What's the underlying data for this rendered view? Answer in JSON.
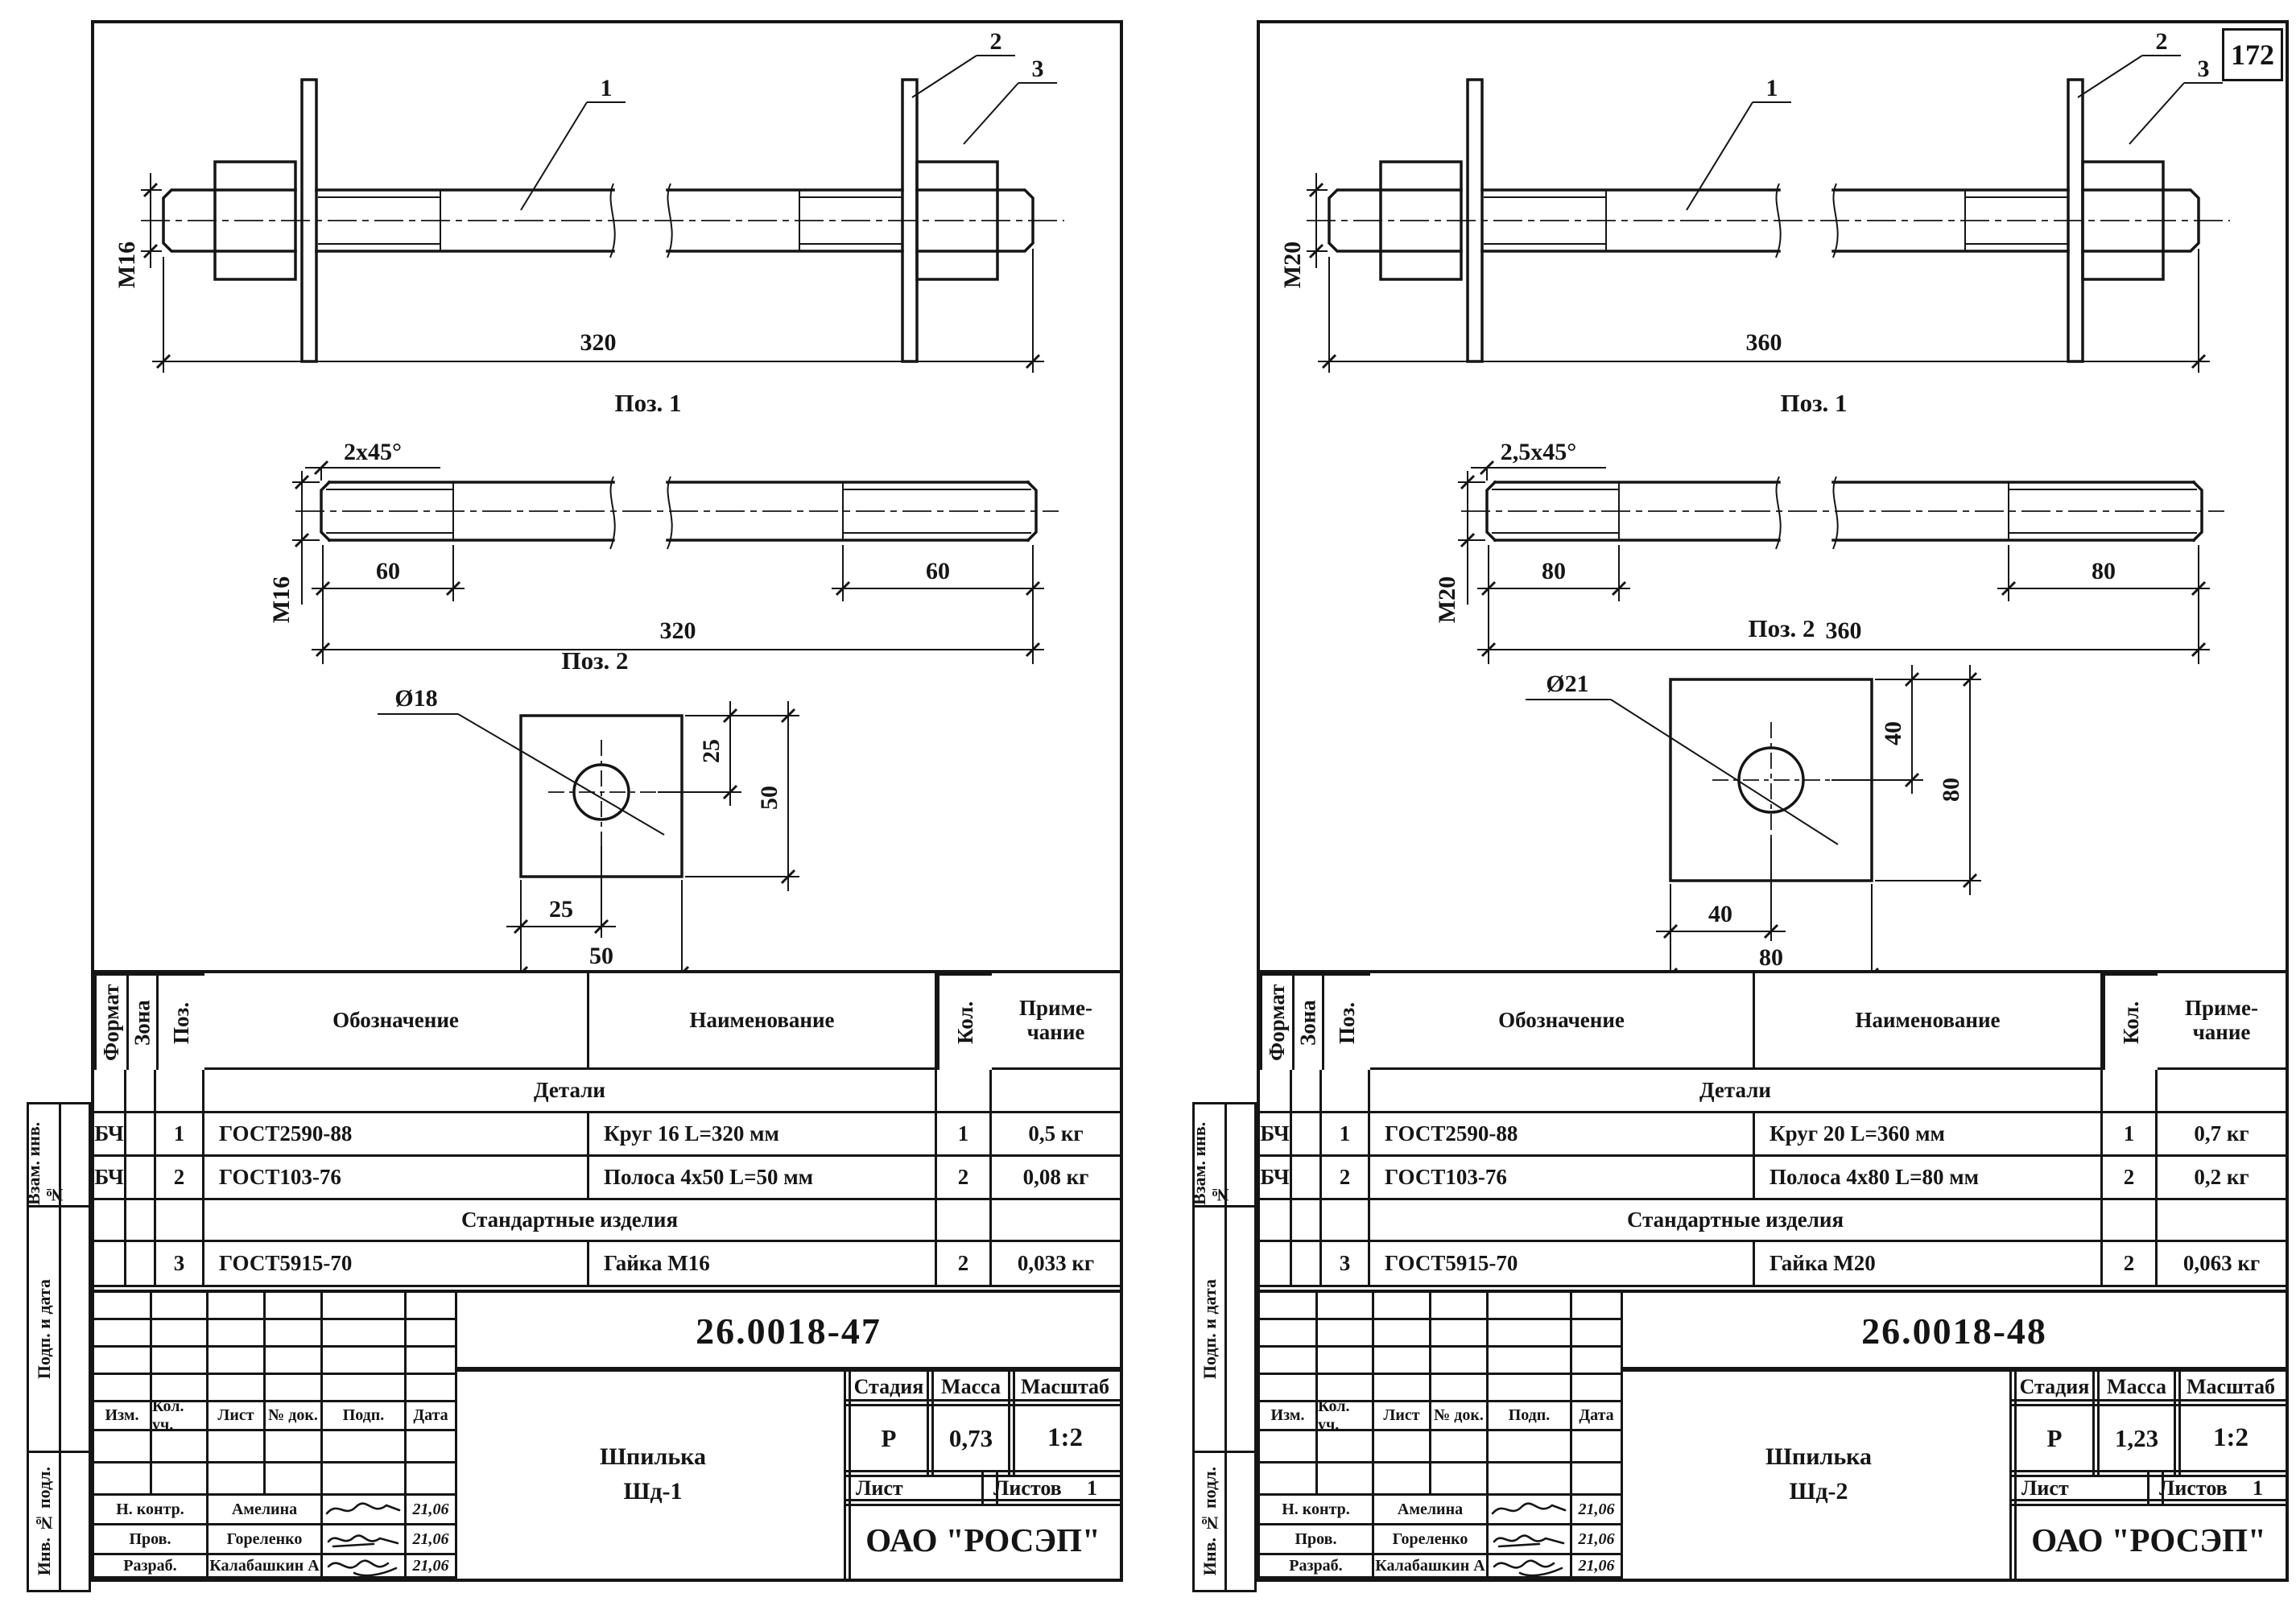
{
  "page": {
    "number": "172"
  },
  "sheets": [
    {
      "drawing": {
        "assembly": {
          "callout1": "1",
          "callout2": "2",
          "callout3": "3",
          "diameter": "M16",
          "length": "320"
        },
        "pos1": {
          "title": "Поз. 1",
          "chamfer": "2x45°",
          "diameter": "M16",
          "thread_left": "60",
          "thread_right": "60",
          "length": "320"
        },
        "pos2": {
          "title": "Поз. 2",
          "hole_dia": "Ø18",
          "offset_v": "25",
          "side_v": "50",
          "offset_h": "25",
          "side_h": "50"
        }
      },
      "spec": {
        "col_format": "Формат",
        "col_zone": "Зона",
        "col_pos": "Поз.",
        "col_desig": "Обозначение",
        "col_name": "Наименование",
        "col_qty": "Кол.",
        "col_note_1": "Приме-",
        "col_note_2": "чание",
        "section1": "Детали",
        "row1": {
          "format": "БЧ",
          "pos": "1",
          "desig": "ГОСТ2590-88",
          "name": "Круг 16 L=320 мм",
          "qty": "1",
          "note": "0,5 кг"
        },
        "row2": {
          "format": "БЧ",
          "pos": "2",
          "desig": "ГОСТ103-76",
          "name": "Полоса 4x50 L=50 мм",
          "qty": "2",
          "note": "0,08 кг"
        },
        "section2": "Стандартные изделия",
        "row3": {
          "pos": "3",
          "desig": "ГОСТ5915-70",
          "name": "Гайка М16",
          "qty": "2",
          "note": "0,033 кг"
        }
      },
      "title_block": {
        "doc_number": "26.0018-47",
        "rev": {
          "izm": "Изм.",
          "kol": "Кол. уч.",
          "list": "Лист",
          "doc": "№ док.",
          "podp": "Подп.",
          "data": "Дата"
        },
        "product1": "Шпилька",
        "product2": "Шд-1",
        "stage_h": "Стадия",
        "mass_h": "Масса",
        "scale_h": "Масштаб",
        "stage": "Р",
        "mass": "0,73",
        "scale": "1:2",
        "list_h": "Лист",
        "listov_h": "Листов",
        "listov_v": "1",
        "sig1": {
          "role": "Н. контр.",
          "name": "Амелина",
          "date": "21,06"
        },
        "sig2": {
          "role": "Пров.",
          "name": "Гореленко",
          "date": "21,06"
        },
        "sig3": {
          "role": "Разраб.",
          "name": "Калабашкин А",
          "date": "21,06"
        },
        "company": "ОАО \"РОСЭП\""
      },
      "sidebar": {
        "box1": "Взам. инв. №",
        "box2": "Подп. и дата",
        "box3": "Инв. № подл."
      }
    },
    {
      "drawing": {
        "assembly": {
          "callout1": "1",
          "callout2": "2",
          "callout3": "3",
          "diameter": "M20",
          "length": "360"
        },
        "pos1": {
          "title": "Поз. 1",
          "chamfer": "2,5x45°",
          "diameter": "M20",
          "thread_left": "80",
          "thread_right": "80",
          "length": "360"
        },
        "pos2": {
          "title": "Поз. 2",
          "hole_dia": "Ø21",
          "offset_v": "40",
          "side_v": "80",
          "offset_h": "40",
          "side_h": "80"
        }
      },
      "spec": {
        "col_format": "Формат",
        "col_zone": "Зона",
        "col_pos": "Поз.",
        "col_desig": "Обозначение",
        "col_name": "Наименование",
        "col_qty": "Кол.",
        "col_note_1": "Приме-",
        "col_note_2": "чание",
        "section1": "Детали",
        "row1": {
          "format": "БЧ",
          "pos": "1",
          "desig": "ГОСТ2590-88",
          "name": "Круг 20 L=360 мм",
          "qty": "1",
          "note": "0,7 кг"
        },
        "row2": {
          "format": "БЧ",
          "pos": "2",
          "desig": "ГОСТ103-76",
          "name": "Полоса 4x80 L=80 мм",
          "qty": "2",
          "note": "0,2 кг"
        },
        "section2": "Стандартные изделия",
        "row3": {
          "pos": "3",
          "desig": "ГОСТ5915-70",
          "name": "Гайка М20",
          "qty": "2",
          "note": "0,063 кг"
        }
      },
      "title_block": {
        "doc_number": "26.0018-48",
        "rev": {
          "izm": "Изм.",
          "kol": "Кол. уч.",
          "list": "Лист",
          "doc": "№ док.",
          "podp": "Подп.",
          "data": "Дата"
        },
        "product1": "Шпилька",
        "product2": "Шд-2",
        "stage_h": "Стадия",
        "mass_h": "Масса",
        "scale_h": "Масштаб",
        "stage": "Р",
        "mass": "1,23",
        "scale": "1:2",
        "list_h": "Лист",
        "listov_h": "Листов",
        "listov_v": "1",
        "sig1": {
          "role": "Н. контр.",
          "name": "Амелина",
          "date": "21,06"
        },
        "sig2": {
          "role": "Пров.",
          "name": "Гореленко",
          "date": "21,06"
        },
        "sig3": {
          "role": "Разраб.",
          "name": "Калабашкин А",
          "date": "21,06"
        },
        "company": "ОАО \"РОСЭП\""
      },
      "sidebar": {
        "box1": "Взам. инв. №",
        "box2": "Подп. и дата",
        "box3": "Инв. № подл."
      }
    }
  ]
}
